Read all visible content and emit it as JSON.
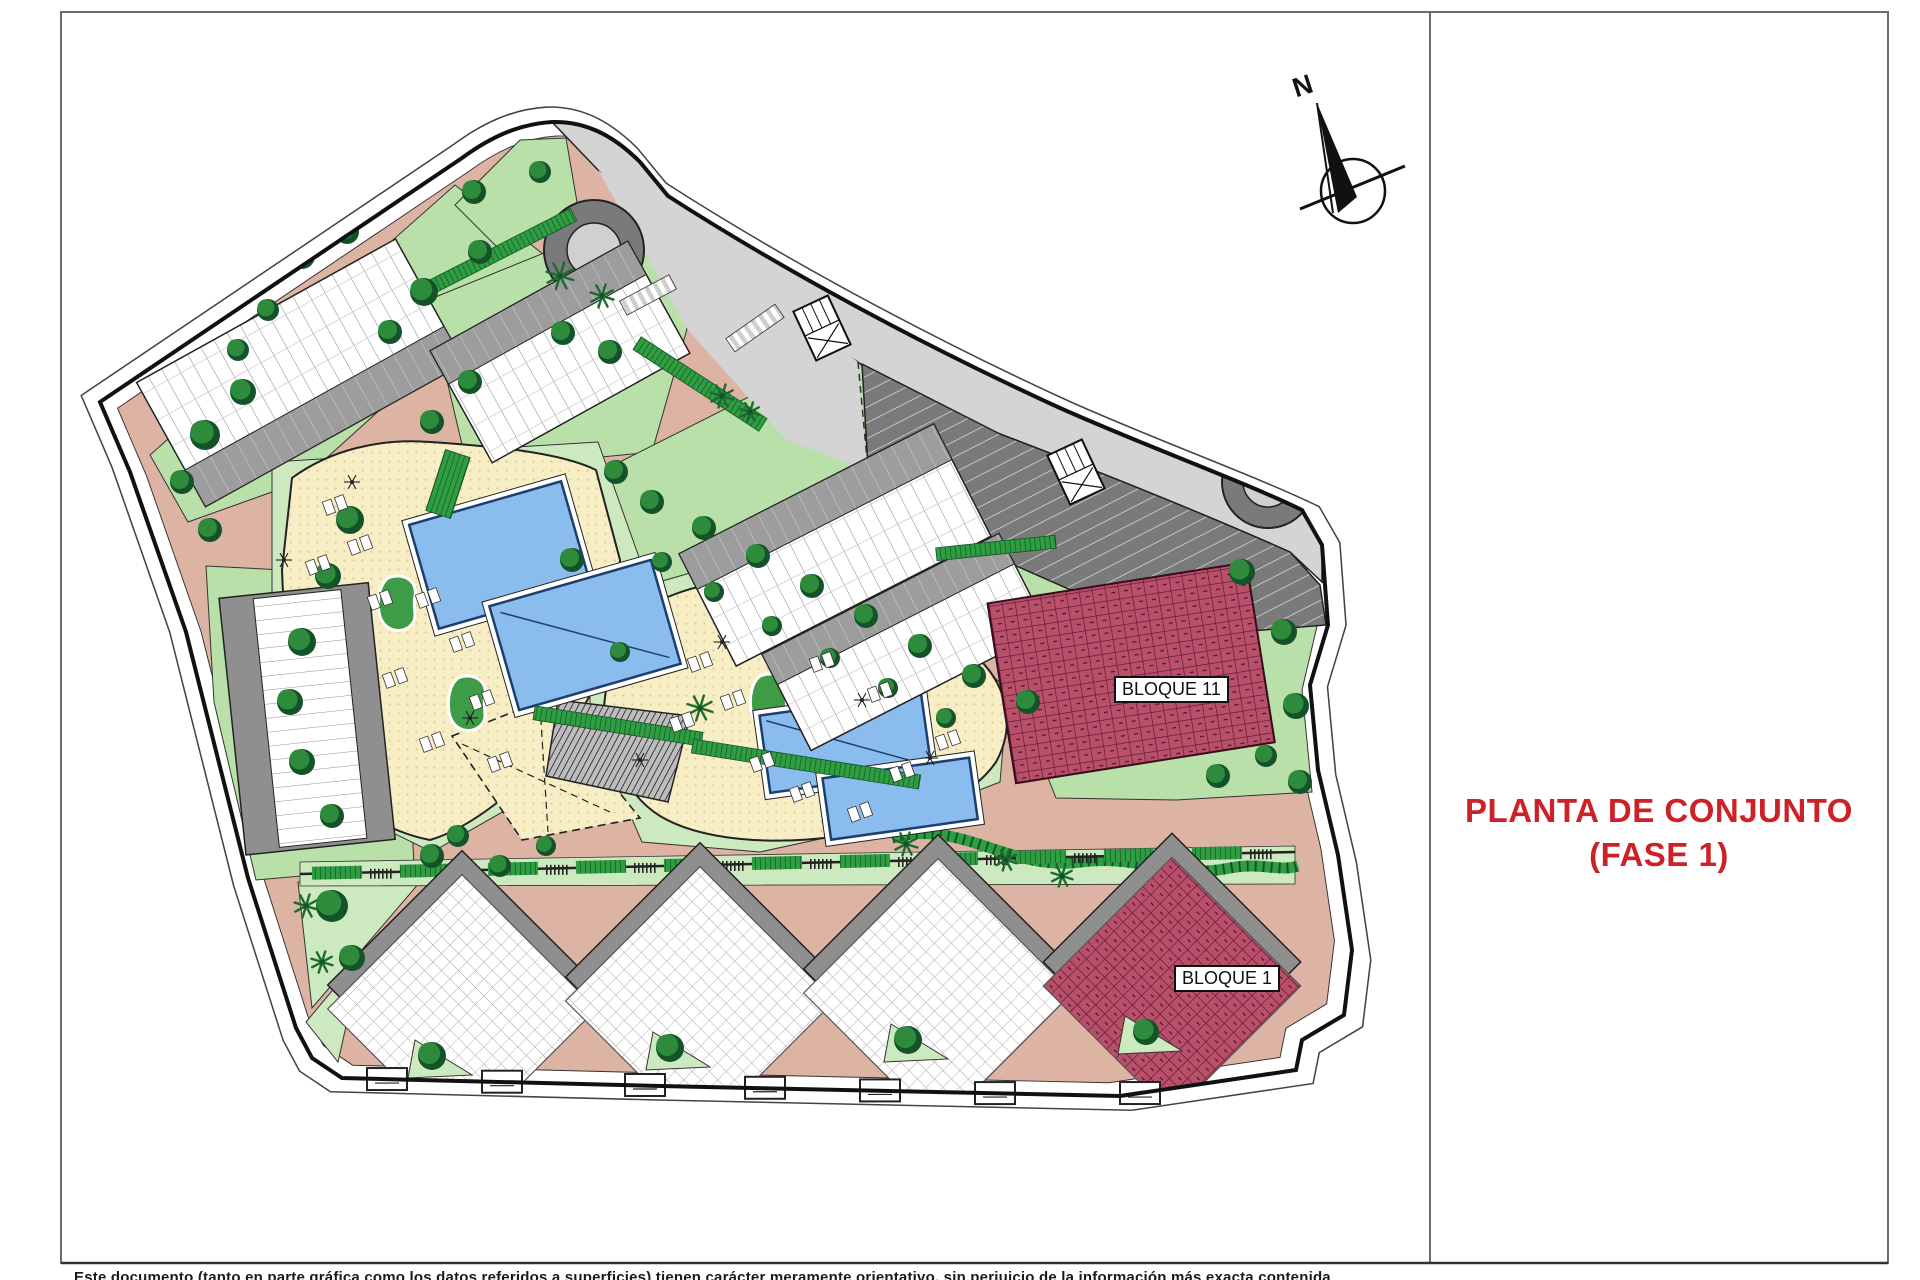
{
  "title_block": {
    "line1": "PLANTA DE CONJUNTO",
    "line2": "(FASE 1)",
    "color": "#cc2127"
  },
  "plan": {
    "compass_north": "N",
    "labels": {
      "bloque_11": "BLOQUE 11",
      "bloque_1": "BLOQUE 1"
    },
    "colors": {
      "path_pink": "#ddb3a4",
      "lawn_green": "#b9e0a8",
      "lawn_light": "#cde9bf",
      "hedge_green": "#2f9e41",
      "tree_dark": "#14532a",
      "tree_light": "#2f8b3c",
      "pool_blue": "#8abced",
      "pool_outline": "#1d3f6e",
      "deck_yellow": "#f8eec6",
      "road_gray": "#d4d4d4",
      "parking_gray": "#7a7a7a",
      "building_gray": "#8f8f8f",
      "block_red": "#b85069",
      "title_red": "#cc2127"
    }
  },
  "footer": {
    "disclaimer": "Este documento (tanto en parte gráfica como los datos referidos a superficies) tienen carácter meramente orientativo, sin perjuicio de la información más exacta contenida"
  }
}
